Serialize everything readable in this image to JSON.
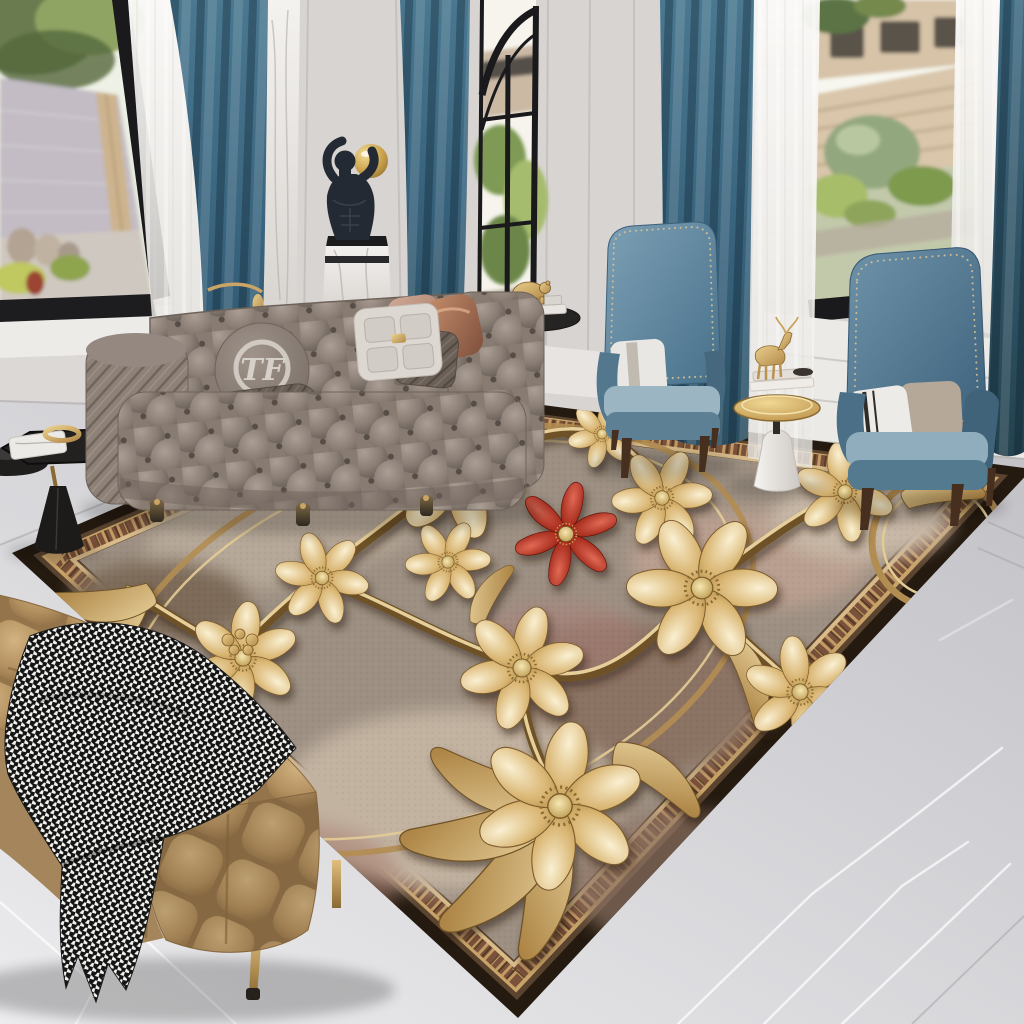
{
  "meta": {
    "description": "Luxury living room photo showcasing a 3D embossed golden floral area rug with one red accent flower",
    "canvas": {
      "width": 1024,
      "height": 1024
    }
  },
  "palette": {
    "wall": "#d8d4d1",
    "wall_shadow": "#c7c3c0",
    "trim_white": "#edebe8",
    "window_frame": "#1a1a1c",
    "sky": "#f4f6ec",
    "foliage": "#7d9552",
    "foliage_dark": "#55683c",
    "fence_stone": "#c3bcc4",
    "fence_wood": "#d4c0a4",
    "lawn": "#c2c9ab",
    "sheer": "#f5f4f1",
    "curtain_teal": "#42708a",
    "curtain_teal_dark": "#2b4e61",
    "marble_floor": "#d9d9db",
    "marble_floor_dark": "#bfbfc4",
    "marble_vein": "#ffffff",
    "floor_seam": "#a6a6ab",
    "sofa_gray": "#8d8178",
    "sofa_gray_dark": "#6e635a",
    "pillow_white": "#dcd7d1",
    "pillow_dark": "#6b6058",
    "pillow_copper": "#b97f5f",
    "pillow_blush": "#c9a28e",
    "chair_blue": "#5f8399",
    "chair_blue_dark": "#3f637b",
    "chair_seat": "#9cb5c3",
    "chair_leg_brown": "#472f20",
    "nailhead_gold": "#d8c193",
    "statue_black": "#232a33",
    "pedestal_marble": "#efece9",
    "sphere_gold": "#d4b166",
    "table_black": "#232120",
    "table_gold": "#cfa75d",
    "cone_white": "#f1efec",
    "bench_tan": "#b3905f",
    "bench_tan_dark": "#9c7a4e",
    "throw_white": "#f2f2ee",
    "throw_black": "#151515",
    "leg_gold": "#c9a765",
    "rug_field": "#9d9083",
    "rug_field_light": "#c0b1a0",
    "rug_field_rose": "#ab7f74",
    "rug_border_brown": "#7a513b",
    "rug_binding": "#241a10",
    "gold": "#c9a464",
    "gold_light": "#f0e2bc",
    "gold_deep": "#8a6531",
    "red_flower": "#a62a1c",
    "red_flower_light": "#d95848"
  },
  "scene": {
    "windows": {
      "left": "garden with stone wall, wooden post and urns",
      "center": "arched black-grid window with house and greenery",
      "right": "garden with slatted wooden fence, shrub and lawn"
    },
    "curtains": {
      "style": "teal velvet drapes with white sheers",
      "panels": 4
    },
    "statue": {
      "description": "black male torso sculpture holding a gold sphere on a white marble pedestal"
    },
    "sofa": {
      "type": "gray tufted chesterfield sofa",
      "monogram": "TF",
      "pillows": [
        "round monogram pillow",
        "quilted lumbar pillow",
        "blush pillow",
        "metallic clasp pillow",
        "quilted square pillow",
        "copper satin pillow"
      ]
    },
    "armchairs": {
      "count": 2,
      "style": "blue velvet wingback chairs with nailhead trim"
    },
    "side_tables": {
      "left": "black pedestal side tables with gold ring bowl and marble tray",
      "center": "gold tray table with deer figurine, books and white cone base",
      "behind_sofa": "black round table with gold bear figurine on books"
    },
    "bench": {
      "style": "tan tufted velvet bench with gold legs",
      "throw": "black and white houndstooth blanket"
    },
    "rug": {
      "style": "3D embossed golden flowers and vines on mottled taupe field",
      "border": "bronze picture-frame border with striped woven band",
      "gold_flowers": 11,
      "red_flowers": 1
    },
    "floor": {
      "material": "gray marble with white veining"
    }
  }
}
